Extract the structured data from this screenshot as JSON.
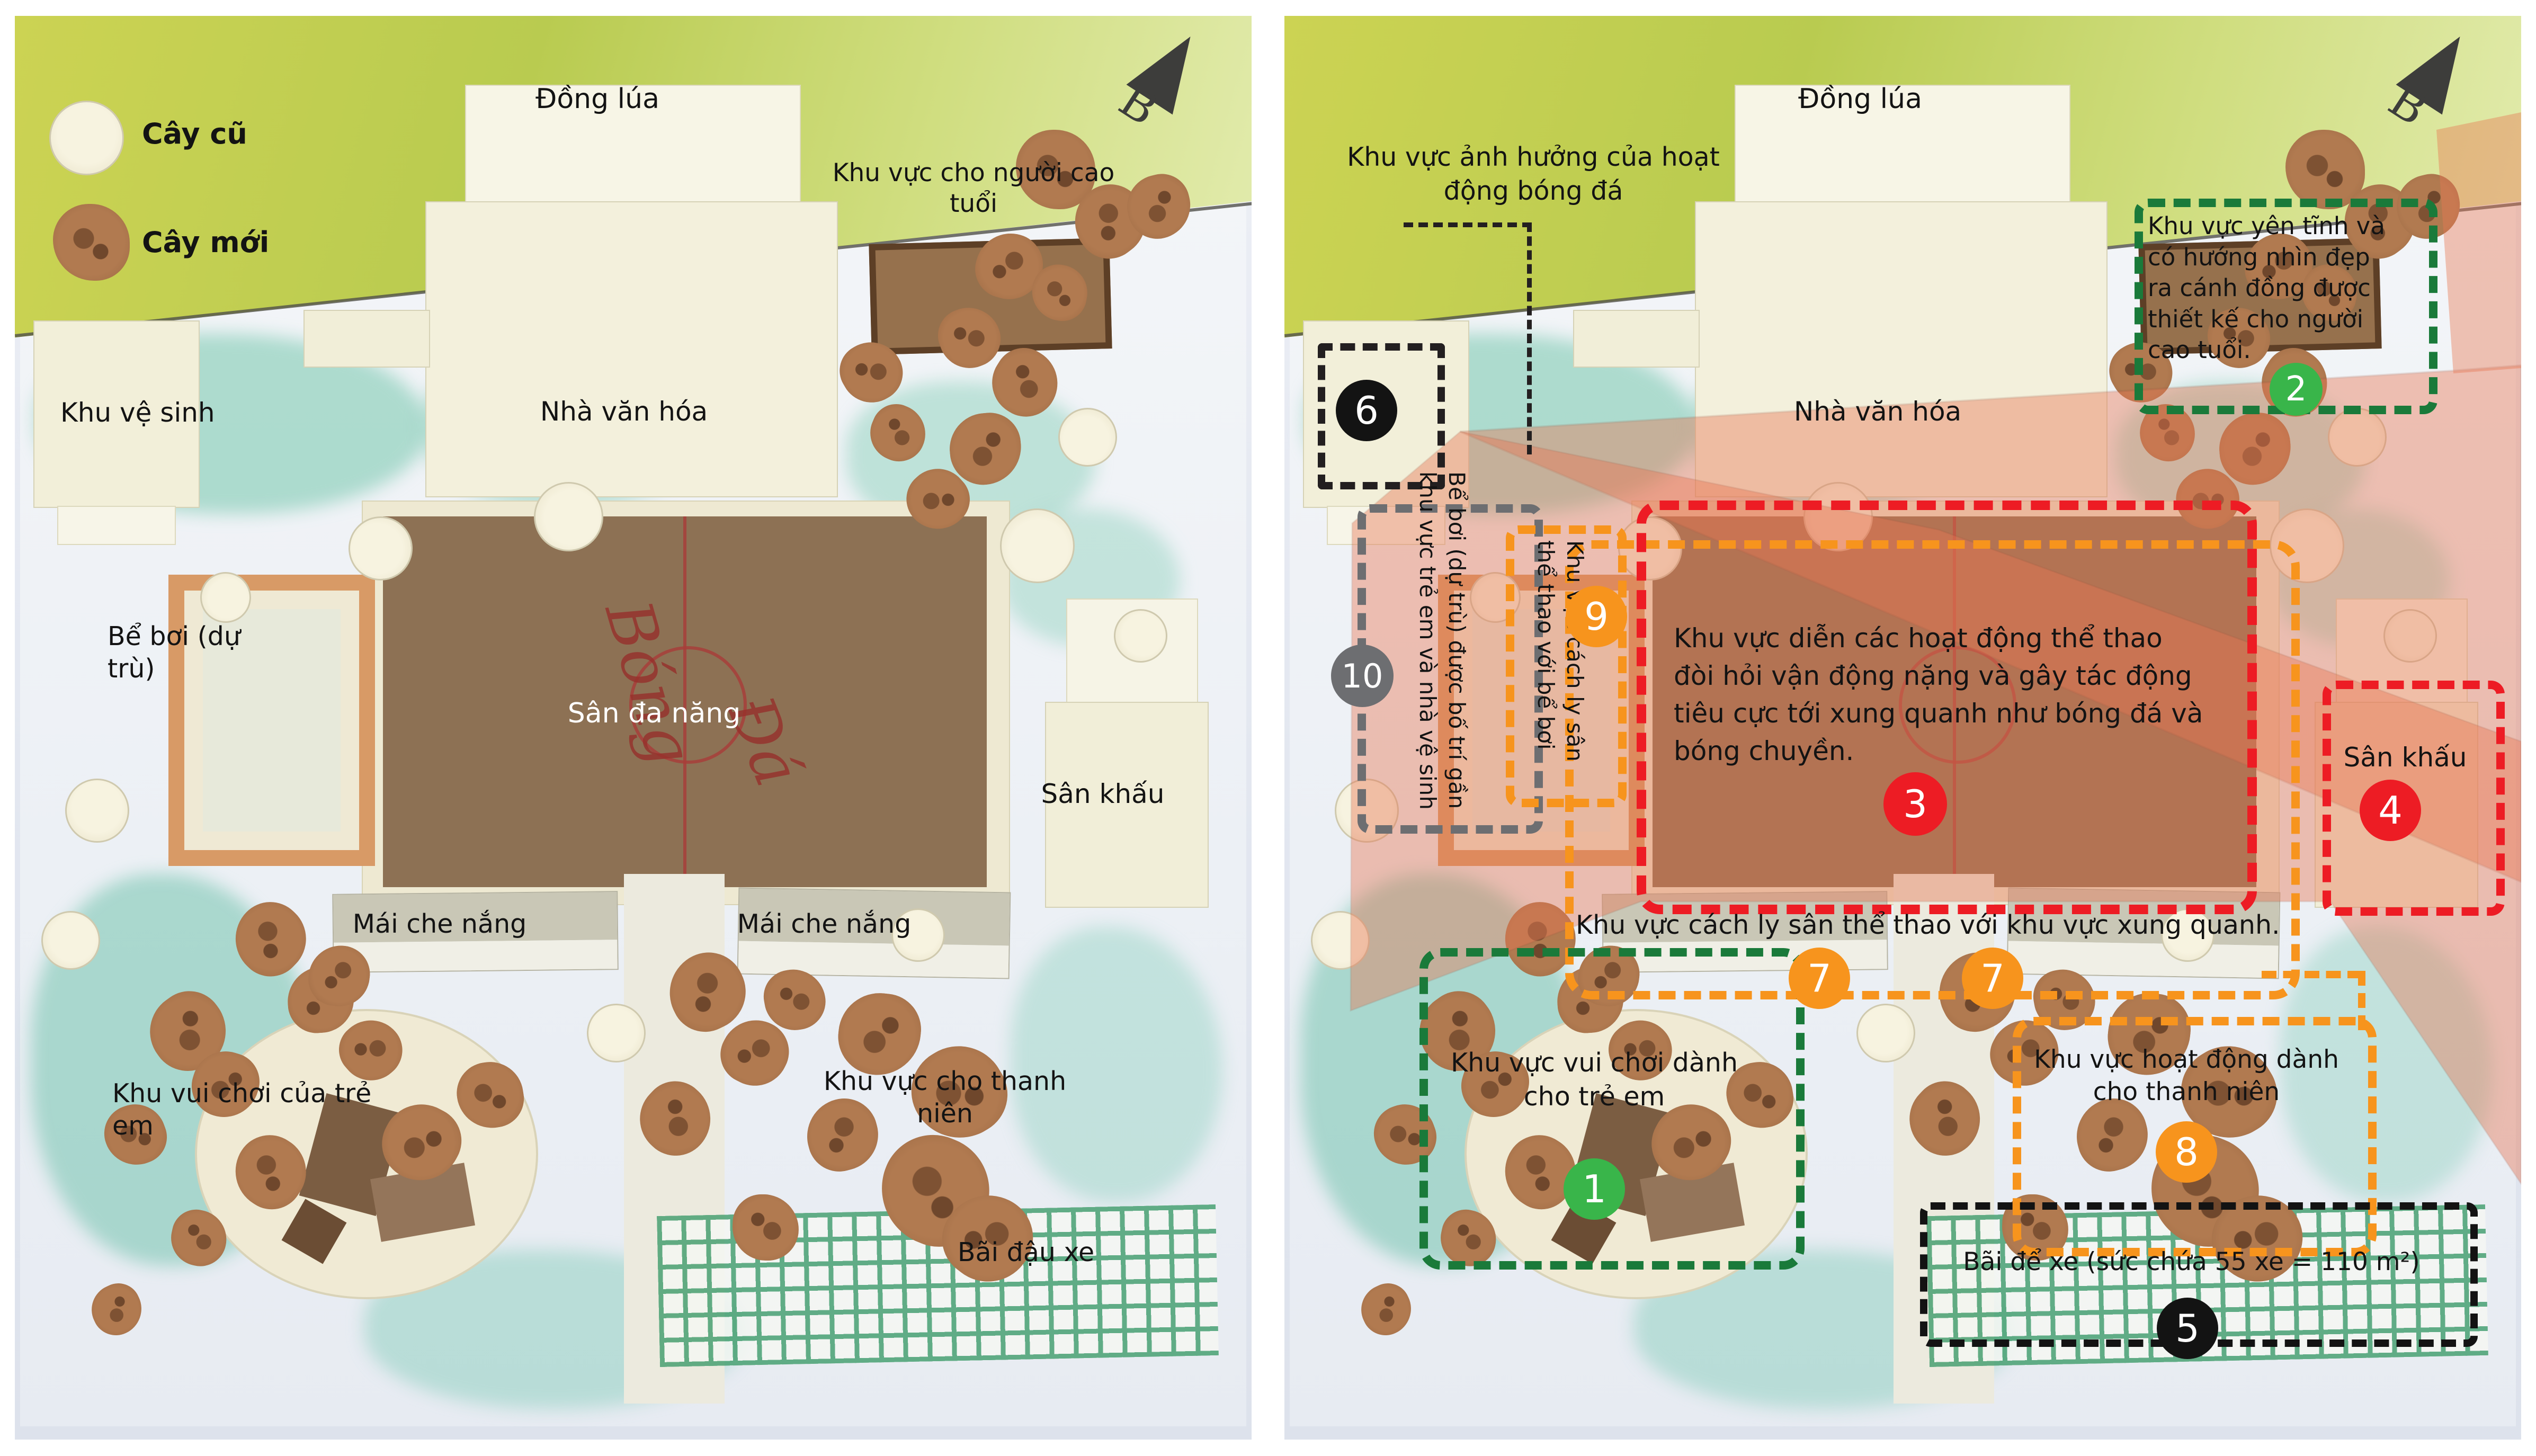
{
  "legend": {
    "old_tree_label": "Cây cũ",
    "new_tree_label": "Cây mới"
  },
  "compass_label": "B",
  "labels": {
    "rice_field": "Đồng lúa",
    "elderly_area": "Khu vực cho người cao tuổi",
    "toilet": "Khu vệ sinh",
    "cultural_house": "Nhà văn hóa",
    "pool": "Bể bơi (dự trù)",
    "multi_court": "Sân đa năng",
    "stage": "Sân khấu",
    "shade_roof": "Mái che nắng",
    "children_play": "Khu vui chơi của trẻ em",
    "youth_area": "Khu vực cho thanh niên",
    "parking": "Bãi đậu xe",
    "court_writing_1": "Bóng",
    "court_writing_2": "Đá"
  },
  "annotations": {
    "football_note": "Khu vực ảnh hưởng của hoạt động bóng đá",
    "zones": {
      "z1": {
        "num": "1",
        "text": "Khu vực vui chơi dành cho trẻ em"
      },
      "z2": {
        "num": "2",
        "text": "Khu vực yên tĩnh và có hướng nhìn đẹp ra cánh đồng được thiết kế cho người cao tuổi."
      },
      "z3": {
        "num": "3",
        "text": "Khu vực diễn các hoạt động thể thao đòi hỏi vận động nặng và gây tác động tiêu cực tới xung quanh như bóng đá và bóng chuyền."
      },
      "z4": {
        "num": "4",
        "text": "Sân khấu"
      },
      "z5": {
        "num": "5",
        "text": "Bãi để xe (sức chứa 55 xe = 110 m²)"
      },
      "z6": {
        "num": "6"
      },
      "z7": {
        "num": "7",
        "text": "Khu vực cách ly sân thể thao với khu vực xung quanh."
      },
      "z7b": {
        "num": "7"
      },
      "z8": {
        "num": "8",
        "text": "Khu vực hoạt động dành cho thanh niên"
      },
      "z9": {
        "num": "9",
        "text": "Khu vực cách ly sân thể thao với bể bơi"
      },
      "z10": {
        "num": "10",
        "text": "Bể bơi (dự trù) được bố trí gần khu vực trẻ em và nhà vệ sinh"
      }
    }
  },
  "colors": {
    "zone_red": "#ed1c24",
    "zone_orange": "#f7941d",
    "zone_green_dark": "#1a7a3a",
    "marker_green": "#39b54a",
    "zone_gray": "#6d6e71",
    "zone_black": "#231f20",
    "overlay_salmon": "#e87653",
    "field_green": "#bfcf55",
    "court_brown": "#8d7154"
  }
}
